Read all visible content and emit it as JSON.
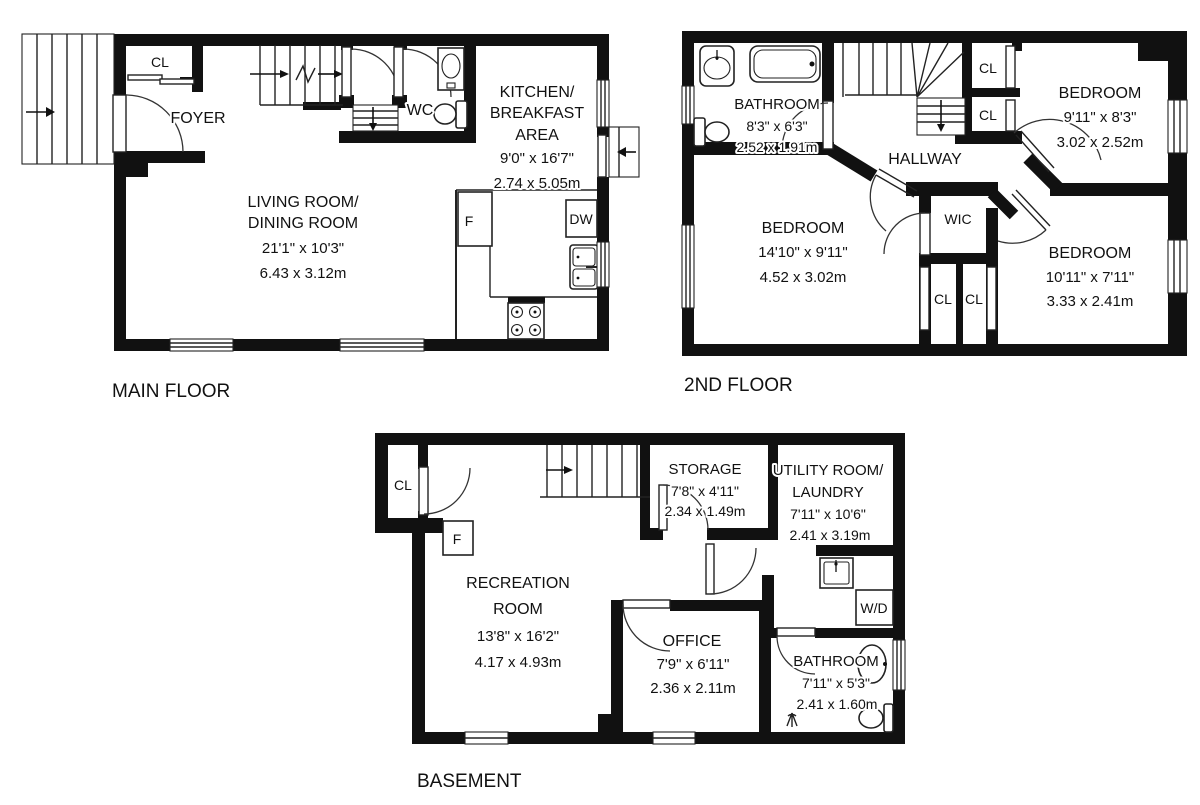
{
  "page": {
    "background": "#ffffff",
    "wall_color": "#111111"
  },
  "floors": {
    "main": {
      "label": "MAIN FLOOR",
      "closet": "CL",
      "foyer": "FOYER",
      "wc": "WC",
      "fridge": "F",
      "dishwasher": "DW",
      "kitchen": {
        "lines": [
          "KITCHEN/",
          "BREAKFAST",
          "AREA",
          "9'0\" x 16'7\"",
          "2.74 x 5.05m"
        ]
      },
      "living": {
        "lines": [
          "LIVING ROOM/",
          "DINING ROOM",
          "21'1\" x 10'3\"",
          "6.43 x 3.12m"
        ]
      }
    },
    "second": {
      "label": "2ND FLOOR",
      "bathroom": {
        "lines": [
          "BATHROOM",
          "8'3\" x 6'3\"",
          "2.52 x 1.91m"
        ]
      },
      "hallway": "HALLWAY",
      "closet_upper_1": "CL",
      "closet_upper_2": "CL",
      "bedroom_ne": {
        "lines": [
          "BEDROOM",
          "9'11\" x 8'3\"",
          "3.02 x 2.52m"
        ]
      },
      "bedroom_w": {
        "lines": [
          "BEDROOM",
          "14'10\" x 9'11\"",
          "4.52 x 3.02m"
        ]
      },
      "bedroom_se": {
        "lines": [
          "BEDROOM",
          "10'11\" x 7'11\"",
          "3.33 x 2.41m"
        ]
      },
      "wic": "WIC",
      "closet_lower_1": "CL",
      "closet_lower_2": "CL"
    },
    "basement": {
      "label": "BASEMENT",
      "closet": "CL",
      "freezer": "F",
      "storage": {
        "lines": [
          "STORAGE",
          "7'8\" x 4'11\"",
          "2.34 x 1.49m"
        ]
      },
      "utility": {
        "lines": [
          "UTILITY ROOM/",
          "LAUNDRY",
          "7'11\" x 10'6\"",
          "2.41 x 3.19m"
        ]
      },
      "recreation": {
        "lines": [
          "RECREATION",
          "ROOM",
          "13'8\" x 16'2\"",
          "4.17 x 4.93m"
        ]
      },
      "office": {
        "lines": [
          "OFFICE",
          "7'9\" x 6'11\"",
          "2.36 x 2.11m"
        ]
      },
      "washer_dryer": "W/D",
      "bathroom": {
        "lines": [
          "BATHROOM",
          "7'11\" x 5'3\"",
          "2.41 x 1.60m"
        ]
      }
    }
  }
}
